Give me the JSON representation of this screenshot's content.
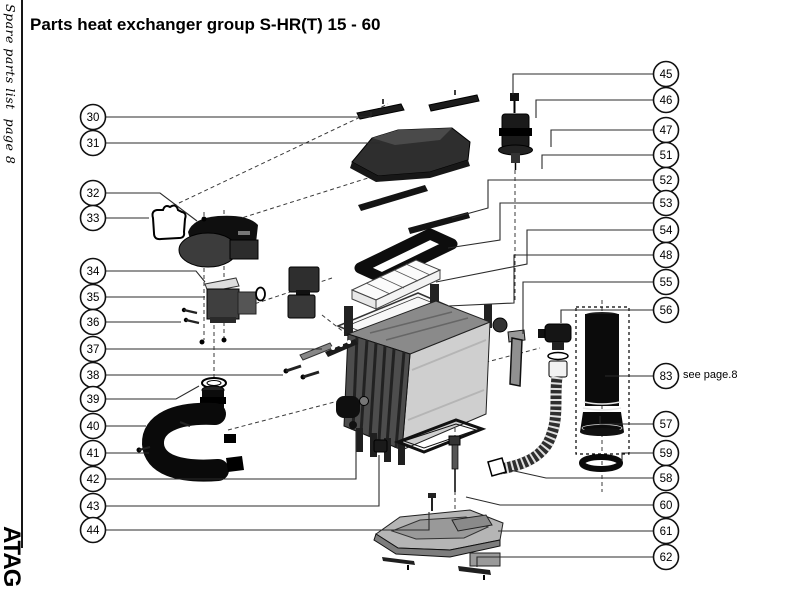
{
  "page": {
    "title": "Parts heat exchanger group S-HR(T) 15 - 60",
    "sidebar_text": "Spare parts list  page 8",
    "logo_text": "ATAG"
  },
  "diagram": {
    "see_note": {
      "text": "see page.8",
      "ref": "83"
    }
  },
  "callouts": [
    {
      "label": "30",
      "cx": 93,
      "cy": 117,
      "line": [
        [
          106,
          117
        ],
        [
          371,
          117
        ],
        [
          371,
          112
        ]
      ]
    },
    {
      "label": "31",
      "cx": 93,
      "cy": 143,
      "line": [
        [
          106,
          143
        ],
        [
          380,
          143
        ]
      ]
    },
    {
      "label": "32",
      "cx": 93,
      "cy": 193,
      "line": [
        [
          106,
          193
        ],
        [
          160,
          193
        ],
        [
          197,
          221
        ]
      ]
    },
    {
      "label": "33",
      "cx": 93,
      "cy": 218,
      "line": [
        [
          106,
          218
        ],
        [
          149,
          218
        ]
      ]
    },
    {
      "label": "34",
      "cx": 93,
      "cy": 271,
      "line": [
        [
          106,
          271
        ],
        [
          196,
          271
        ],
        [
          205,
          282
        ]
      ]
    },
    {
      "label": "35",
      "cx": 93,
      "cy": 297,
      "line": [
        [
          106,
          297
        ],
        [
          205,
          297
        ]
      ]
    },
    {
      "label": "36",
      "cx": 93,
      "cy": 322,
      "line": [
        [
          106,
          322
        ],
        [
          181,
          322
        ]
      ]
    },
    {
      "label": "37",
      "cx": 93,
      "cy": 349,
      "line": [
        [
          106,
          349
        ],
        [
          322,
          349
        ]
      ]
    },
    {
      "label": "38",
      "cx": 93,
      "cy": 375,
      "line": [
        [
          106,
          375
        ],
        [
          283,
          375
        ]
      ]
    },
    {
      "label": "39",
      "cx": 93,
      "cy": 399,
      "line": [
        [
          106,
          399
        ],
        [
          176,
          399
        ],
        [
          199,
          386
        ]
      ]
    },
    {
      "label": "40",
      "cx": 93,
      "cy": 426,
      "line": [
        [
          106,
          426
        ],
        [
          146,
          426
        ]
      ]
    },
    {
      "label": "41",
      "cx": 93,
      "cy": 453,
      "line": [
        [
          106,
          453
        ],
        [
          149,
          453
        ]
      ]
    },
    {
      "label": "42",
      "cx": 93,
      "cy": 479,
      "line": [
        [
          106,
          479
        ],
        [
          356,
          479
        ],
        [
          356,
          431
        ]
      ]
    },
    {
      "label": "43",
      "cx": 93,
      "cy": 506,
      "line": [
        [
          106,
          506
        ],
        [
          379,
          506
        ],
        [
          379,
          455
        ]
      ]
    },
    {
      "label": "44",
      "cx": 93,
      "cy": 530,
      "line": [
        [
          106,
          530
        ],
        [
          429,
          530
        ],
        [
          429,
          512
        ]
      ]
    },
    {
      "label": "45",
      "cx": 666,
      "cy": 74,
      "line": [
        [
          653,
          74
        ],
        [
          513,
          74
        ],
        [
          513,
          95
        ]
      ]
    },
    {
      "label": "46",
      "cx": 666,
      "cy": 100,
      "line": [
        [
          653,
          100
        ],
        [
          536,
          100
        ],
        [
          536,
          118
        ]
      ]
    },
    {
      "label": "47",
      "cx": 666,
      "cy": 130,
      "line": [
        [
          653,
          130
        ],
        [
          551,
          130
        ],
        [
          551,
          147
        ]
      ]
    },
    {
      "label": "51",
      "cx": 666,
      "cy": 155,
      "line": [
        [
          653,
          155
        ],
        [
          542,
          155
        ],
        [
          542,
          169
        ]
      ]
    },
    {
      "label": "52",
      "cx": 666,
      "cy": 180,
      "line": [
        [
          653,
          180
        ],
        [
          488,
          180
        ],
        [
          488,
          208
        ],
        [
          452,
          218
        ]
      ]
    },
    {
      "label": "53",
      "cx": 666,
      "cy": 203,
      "line": [
        [
          653,
          203
        ],
        [
          500,
          203
        ],
        [
          500,
          240
        ],
        [
          448,
          248
        ]
      ]
    },
    {
      "label": "54",
      "cx": 666,
      "cy": 230,
      "line": [
        [
          653,
          230
        ],
        [
          527,
          230
        ],
        [
          527,
          264
        ],
        [
          436,
          282
        ]
      ]
    },
    {
      "label": "48",
      "cx": 666,
      "cy": 255,
      "line": [
        [
          653,
          255
        ],
        [
          514,
          255
        ],
        [
          514,
          303
        ],
        [
          448,
          306
        ]
      ]
    },
    {
      "label": "55",
      "cx": 666,
      "cy": 282,
      "line": [
        [
          653,
          282
        ],
        [
          523,
          282
        ],
        [
          523,
          334
        ]
      ]
    },
    {
      "label": "56",
      "cx": 666,
      "cy": 310,
      "line": [
        [
          653,
          310
        ],
        [
          561,
          310
        ],
        [
          561,
          323
        ]
      ]
    },
    {
      "label": "83",
      "cx": 666,
      "cy": 376,
      "line": [
        [
          653,
          376
        ],
        [
          605,
          376
        ]
      ]
    },
    {
      "label": "57",
      "cx": 666,
      "cy": 424,
      "line": [
        [
          653,
          424
        ],
        [
          600,
          424
        ],
        [
          600,
          416
        ]
      ]
    },
    {
      "label": "59",
      "cx": 666,
      "cy": 453,
      "line": [
        [
          653,
          453
        ],
        [
          622,
          453
        ],
        [
          622,
          461
        ]
      ]
    },
    {
      "label": "58",
      "cx": 666,
      "cy": 478,
      "line": [
        [
          653,
          478
        ],
        [
          546,
          478
        ],
        [
          510,
          470
        ]
      ]
    },
    {
      "label": "60",
      "cx": 666,
      "cy": 505,
      "line": [
        [
          653,
          505
        ],
        [
          500,
          505
        ],
        [
          466,
          497
        ]
      ]
    },
    {
      "label": "61",
      "cx": 666,
      "cy": 531,
      "line": [
        [
          653,
          531
        ],
        [
          498,
          531
        ]
      ]
    },
    {
      "label": "62",
      "cx": 666,
      "cy": 557,
      "line": [
        [
          653,
          557
        ],
        [
          477,
          557
        ],
        [
          477,
          567
        ]
      ]
    }
  ]
}
